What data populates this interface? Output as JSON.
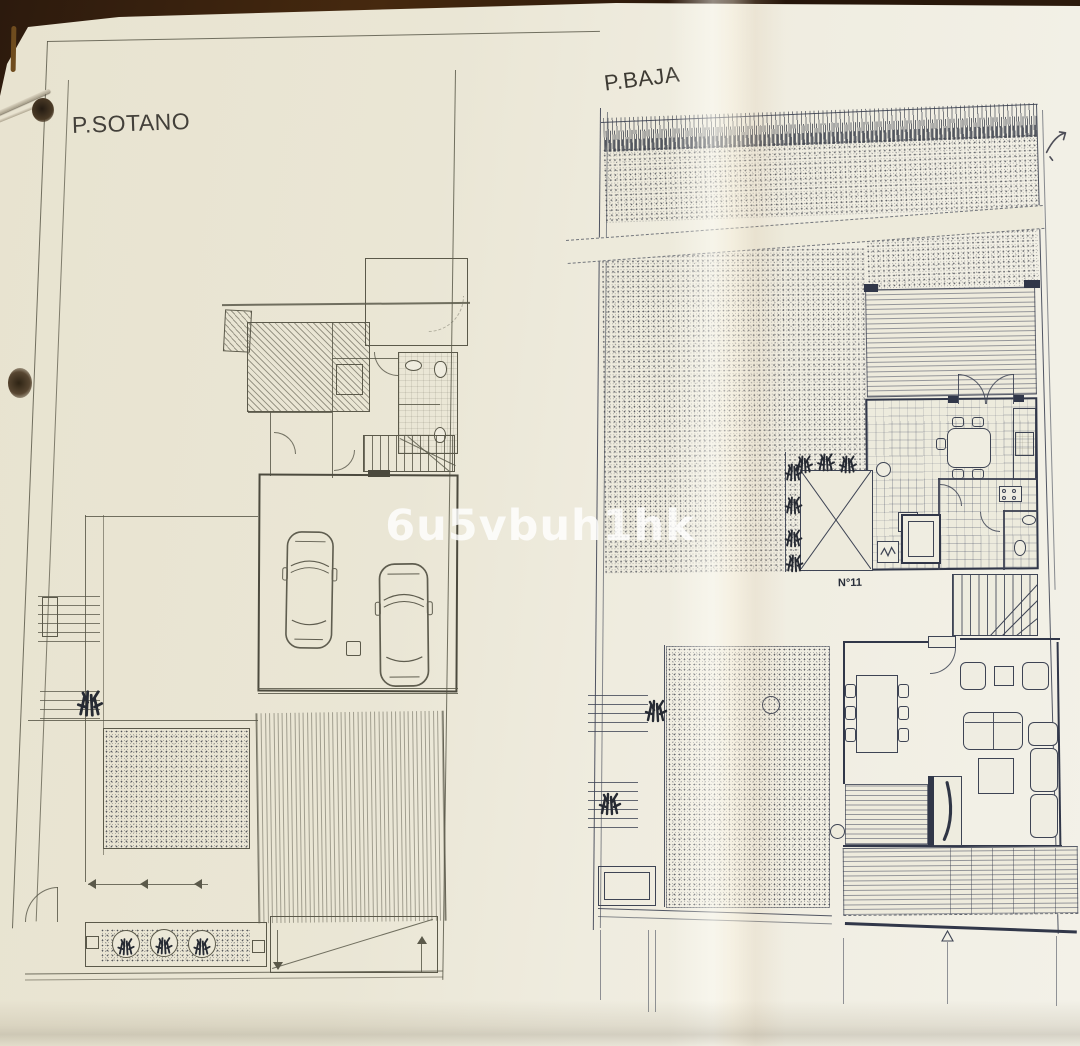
{
  "document": {
    "type": "architectural floor plan photograph",
    "watermark": "6u5vbuh1hk",
    "plans": [
      {
        "id": "sotano",
        "title": "P.SOTANO"
      },
      {
        "id": "baja",
        "title": "P.BAJA",
        "annotations": {
          "house_number": "N°11"
        }
      }
    ]
  },
  "colors": {
    "paper": "#ebe7d6",
    "paper_light": "#f3f1e8",
    "table_brown": "#33200f",
    "ink_basement_plan": "#5b594a",
    "ink_ground_plan": "#3e4454",
    "watermark_color": "rgba(255,255,255,0.8)"
  },
  "icons": {
    "car-icon": "top-view car outline",
    "shrub-icon": "dense plant scribble",
    "tree-icon": "circular plant in planter",
    "toilet-icon": "toilet fixture",
    "sink-icon": "basin fixture",
    "stove-icon": "4-burner cooktop",
    "dining-table-icon": "table with chairs",
    "sofa-icon": "sofa outline",
    "stairs-icon": "staircase with treads",
    "fireplace-icon": "fireplace with flame stroke",
    "arrow-icon": "direction arrow",
    "staple-icon": "metal staple",
    "hole-punch-icon": "dark punched hole",
    "pen-mark-icon": "brown pen stroke",
    "scribble-icon": "handwritten doodle"
  }
}
